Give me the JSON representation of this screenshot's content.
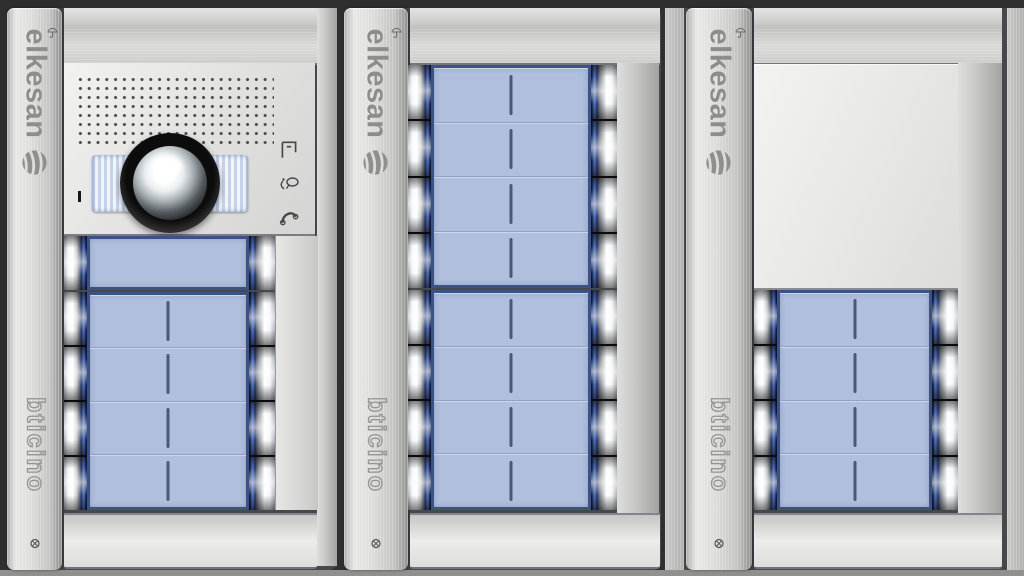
{
  "image_type": "product-photo",
  "subject": "three modular audio-video door entry panels mounted side by side",
  "brand": {
    "top_label": "elkesan",
    "bottom_label": "bticino"
  },
  "colors": {
    "background": "#2f2f2f",
    "frame_silver": "#d6d6d4",
    "button_panel_blue": "#b1bfde",
    "panel_border_blue": "#3c5284",
    "button_stripe_blue": "#5377cf",
    "lens_black": "#111111",
    "led_light_blue": "#c4d2ea"
  },
  "panels": [
    {
      "label": "entrance-panel-1",
      "modules": [
        "top-blank-module",
        "camera-speaker-module",
        "single-row-button-module",
        "button-module-4x2",
        "plinth-module"
      ]
    },
    {
      "label": "entrance-panel-2",
      "modules": [
        "top-blank-module",
        "button-module-4x2",
        "button-module-4x2",
        "plinth-module"
      ]
    },
    {
      "label": "entrance-panel-3",
      "modules": [
        "top-blank-module",
        "blank-cover-module",
        "button-module-4x2",
        "plinth-module"
      ]
    }
  ],
  "icons": [
    "umbrella-icon",
    "swirl-logo",
    "door-release-icon",
    "speak-icon",
    "handset-icon",
    "screw-icon",
    "camera-lens",
    "speaker-grille"
  ]
}
